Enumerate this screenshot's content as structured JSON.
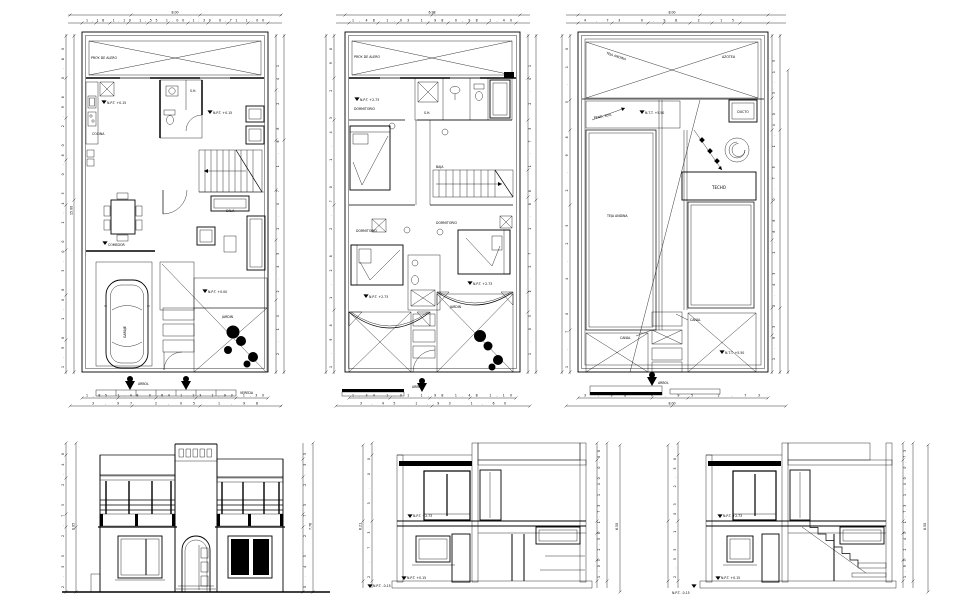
{
  "sheet": {
    "bg": "#ffffff",
    "ink": "#000000"
  },
  "p1": {
    "total_top": "8.00",
    "dims_top": "1.18 1.10 1.55 1.00 1.30 0.71 1.00",
    "dims_left": "1.98 1.08 3.00 1.43 0.80 2.98 0.60",
    "total_left": "15.00",
    "dims_right": "2.14 2.45 1.47 1.68 2.41",
    "dims_bottom": "1.85 1.48 0.64 1.23 1.93 1.30",
    "total_bottom": "3.97 2.05 1.98",
    "eave": "PROY. DE ALERO",
    "kitchen": "COCINA",
    "bath": "S.H.",
    "dining": "COMEDOR",
    "living": "SALA",
    "garage": "GARAJE",
    "garden": "JARDIN",
    "walk": "VEREDA",
    "level_a": "N.P.T. +0.15",
    "level_b": "N.P.T. +0.00",
    "tree": "ARBOL"
  },
  "p2": {
    "total_top": "6.98",
    "dims_top": "1.48 1.03 1.98 0.98 1.40",
    "dims_left": "1.98 1.28 2.70 1.43 2.98",
    "dims_right": "1.03 1.27 1.88 1.75 2.41",
    "dims_bottom": "1.34 1.01 1.98 1.48 1.10",
    "total_bottom": "3.45 1.93 1.60",
    "bed": "DORMITORIO",
    "bath": "S.H.",
    "stair": "BAJA",
    "garden": "JARDIN",
    "eave": "PROY. DE ALERO",
    "level_a": "N.P.T. +2.73",
    "tree": "ARBOL"
  },
  "p3": {
    "total_top": "8.00",
    "dims_top": "4.73 0.98 2.15",
    "dims_left": "1.70 4.25 2.98 3.10",
    "dims_right": "1.93 2.43 1.88 0.75 1.40 3.15",
    "dims_bottom": "3.98 0.95 2.73",
    "total_bottom": "8.00",
    "teja": "TEJA ANDINA",
    "azotea": "AZOTEA",
    "pend": "PEND. 30%",
    "ducto": "DUCTO",
    "techo": "TECHO",
    "canal1": "CANAL",
    "canal2": "CANAL",
    "level_a": "N.T.T. +5.50",
    "tree": "ARBOL"
  },
  "e1": {
    "dims_left": "2.55 2.73 2.48",
    "total_left": "8.05",
    "dims_right": "0.45 2.73 2.55",
    "total_right": "7.76"
  },
  "e2": {
    "dims_left": "2.73 3.00",
    "total_left": "6.21",
    "dims_right": "1.03 2.58 1.73 1.40 0.88",
    "total_right": "6.50",
    "level_a": "N.P.T. +2.73",
    "level_b": "N.P.T. +0.15",
    "level_c": "N.P.T. -0.15"
  },
  "e3": {
    "dims_left": "2.55 1.03 2.58",
    "dims_right": "1.93 2.43 1.73 1.40 0.73",
    "total_right": "6.50",
    "level_a": "N.P.T. +2.73",
    "level_b": "N.P.T. +0.15",
    "level_c": "N.P.T. -0.15"
  }
}
